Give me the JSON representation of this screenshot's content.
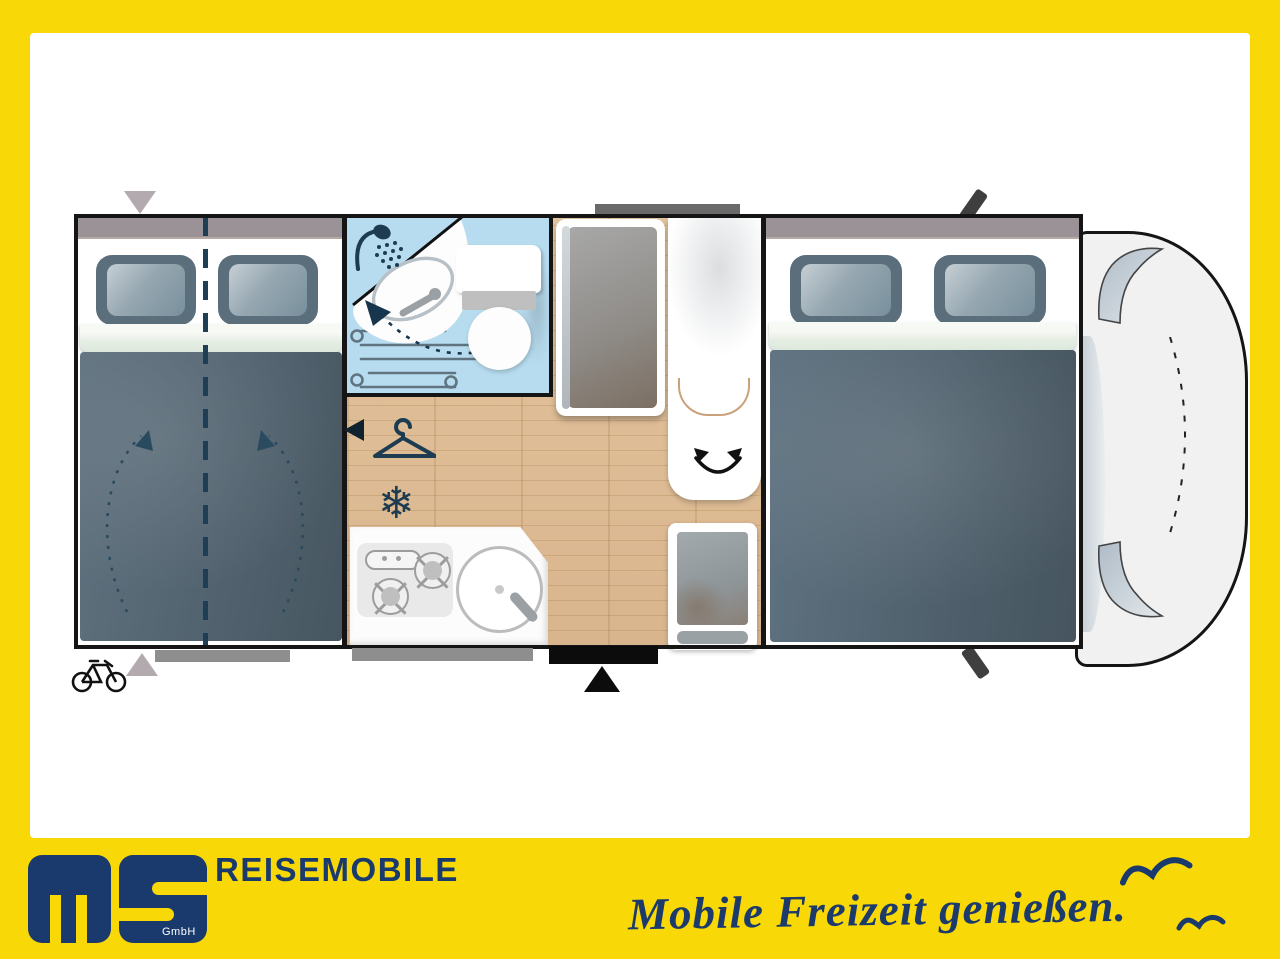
{
  "brand": {
    "logo_suffix": "GmbH",
    "wordmark": "REISEMOBILE",
    "tagline": "Mobile Freizeit genießen."
  },
  "theme": {
    "accent_yellow": "#F8D806",
    "brand_navy": "#1A3A6E",
    "wall_black": "#151515",
    "bath_blue": "#B7DCEF",
    "wood_floor": "#DDBD98",
    "bed_slate": "#5A6C79",
    "icon_teal": "#1D3C52"
  },
  "floorplan": {
    "type": "motorhome-top-view-layout",
    "features": [
      "rear-double-bed-splittable",
      "lift-direction-arrows",
      "bathroom-with-shower",
      "folding-washbasin",
      "toilet",
      "wardrobe-with-mirror-door",
      "clothes-hanger-marker",
      "refrigerator-snowflake",
      "kitchen-two-burner-stove",
      "kitchen-round-sink",
      "swivel-seat",
      "side-seat",
      "front-double-bed",
      "driver-cab",
      "entry-door",
      "bike-rack-marker",
      "roof-vent",
      "side-mirrors"
    ],
    "icons": {
      "snowflake_glyph": "❄"
    }
  }
}
